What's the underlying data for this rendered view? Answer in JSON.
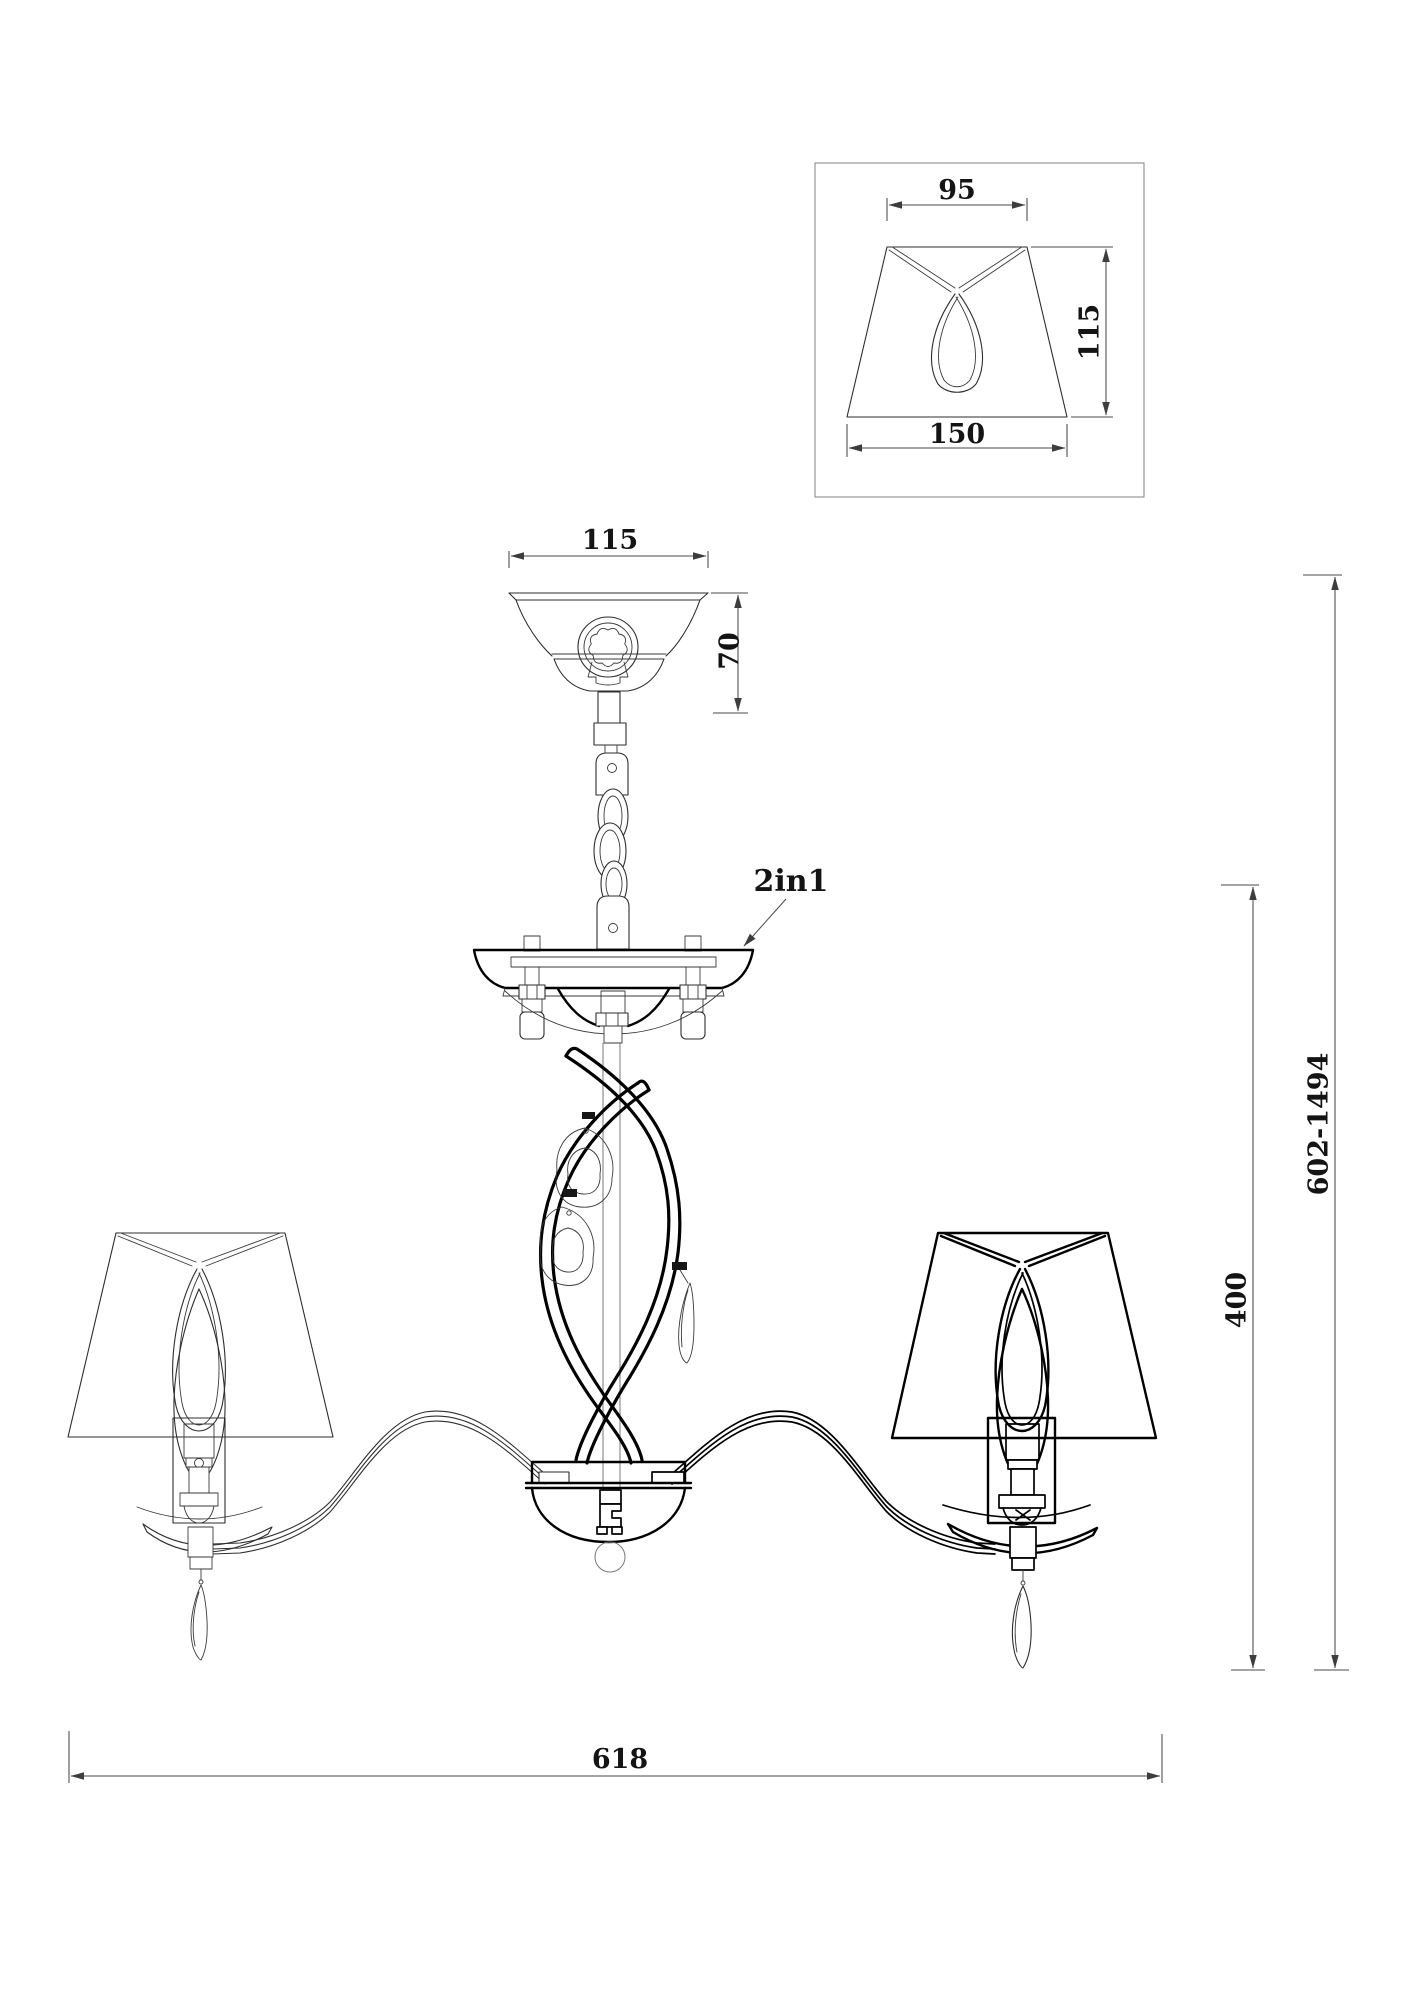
{
  "detail_view": {
    "top_width": "95",
    "side_height": "115",
    "bottom_width": "150"
  },
  "canopy": {
    "width": "115",
    "height": "70"
  },
  "mount": {
    "label": "2in1"
  },
  "dimensions": {
    "total_width": "618",
    "body_height": "400",
    "overall_height_range": "602-1494"
  },
  "colors": {
    "background": "#ffffff",
    "line_thin": "#2e2e2e",
    "line_bold": "#000000",
    "dimension": "#4a4a4a"
  }
}
